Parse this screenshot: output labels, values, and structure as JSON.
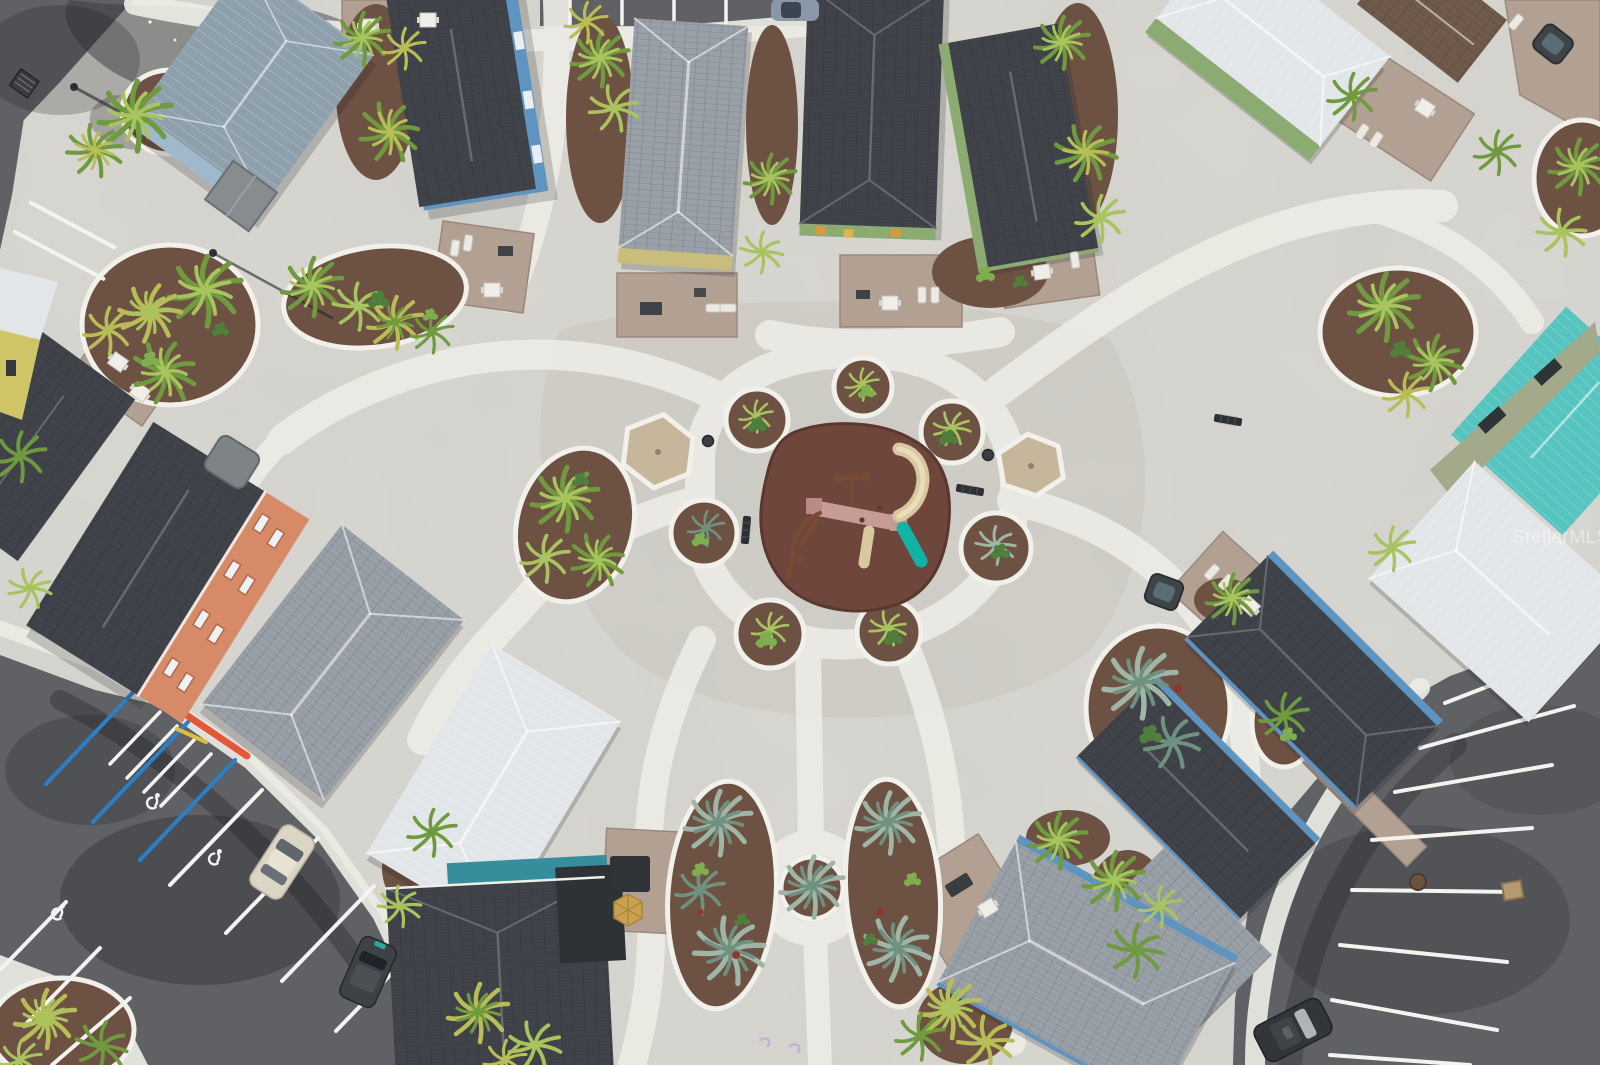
{
  "meta": {
    "type": "aerial-drone-photograph",
    "description": "Overhead drone view of a coastal resort cottage community: rows of small rental cottages with mixed shingle and metal roofs arranged around a central concrete courtyard that has a playground on brown rubber surfacing, sand pads, looping white walkways, mulched palm planting islands, an orange multi-story building at left, and asphalt parking lots with white and blue striping in the lower corners."
  },
  "watermark": {
    "text": "StellarMLS"
  },
  "palette": {
    "concrete": "#d9d7d1",
    "plaza": "#d1cfc8",
    "path": "#ecebe5",
    "curb": "#f2f0ea",
    "asphalt": "#606165",
    "asphalt_dark": "#44454a",
    "mulch": "#6d5244",
    "mulch_dark": "#594336",
    "sand": "#c6b69c",
    "rubber": "#6f463c",
    "rubber_dark": "#5a382e",
    "palm": "#6f9a3e",
    "palm_light": "#a9c45e",
    "palm_yellow": "#b9bd56",
    "palmetto": "#9fb6a6",
    "palmetto_dark": "#70917f",
    "shrub": "#4f7f3a",
    "shrub_light": "#7fae4f",
    "roof_charcoal": "#40444a",
    "roof_ridge": "#646a72",
    "roof_gray": "#9aa0a8",
    "roof_gray_light": "#b0b5bb",
    "roof_metal": "#8fa0ad",
    "roof_white": "#e3e6e9",
    "roof_teal": "#56c4bf",
    "roof_brown": "#705a4b",
    "wall_blue": "#5f93c0",
    "wall_lightblue": "#9fb8cc",
    "wall_green": "#8cab72",
    "wall_orange": "#d78a68",
    "wall_teal": "#368d9c",
    "wall_khaki": "#c9bd7c",
    "wall_sage": "#a3aa8b",
    "paver": "#b2a093",
    "paver_dark": "#9a887c",
    "line_white": "#f4f3f0",
    "line_blue": "#2a7fc6",
    "curb_red": "#e2593a",
    "curb_yellow": "#ddbe3c",
    "slide_teal": "#12b2a4",
    "slide_tan": "#d9c89f",
    "deck_pink": "#c79b96",
    "equip_brown": "#7b4a32",
    "bench": "#2e3134",
    "car_beige": "#dbd5c6",
    "car_dark": "#3e4145",
    "car_suv": "#32363b",
    "car_top": "#8a97a6",
    "shadow": "rgba(30,32,36,0.20)",
    "watermark_color": "rgba(255,255,255,0.45)"
  },
  "scene": {
    "ground": {
      "surfaces": [
        "poured concrete courtyard",
        "white concrete walkways",
        "asphalt parking lots",
        "paver patios",
        "mulch planting beds"
      ]
    },
    "playground": {
      "surface": "brown rubber safety surface",
      "equipment": [
        "climbing structure with pink decks",
        "tan curved tube slide",
        "teal slide",
        "tan straight slide",
        "overhead bar"
      ],
      "nearby": [
        "2 park benches",
        "2 trash cans",
        "2 sand pads"
      ]
    },
    "planting_islands": {
      "edging": "white concrete curb",
      "ground_cover": "brown mulch",
      "plants": [
        "cabbage palms",
        "silver palmettos",
        "yellow-green palms",
        "low shrubs"
      ]
    },
    "buildings": [
      {
        "id": "cottage-nw-metal",
        "type": "cottage",
        "roof": "roof_metal",
        "wall": "wall_lightblue",
        "position": "top-left"
      },
      {
        "id": "cottage-n-blue",
        "type": "cottage",
        "roof": "roof_charcoal",
        "wall": "wall_blue",
        "position": "top, left of center"
      },
      {
        "id": "cottage-n-gray",
        "type": "cottage",
        "roof": "roof_gray",
        "wall": "wall_khaki",
        "position": "top center-left"
      },
      {
        "id": "cottage-n-green",
        "type": "cottage",
        "roof": "roof_charcoal",
        "wall": "wall_green",
        "position": "top center"
      },
      {
        "id": "cottage-n-green2",
        "type": "cottage",
        "roof": "roof_charcoal",
        "wall": "wall_green",
        "position": "top center-right"
      },
      {
        "id": "cottage-ne-white",
        "type": "cottage",
        "roof": "roof_white",
        "wall": "wall_green",
        "position": "top right"
      },
      {
        "id": "cottage-ne-brown",
        "type": "cottage",
        "roof": "roof_brown",
        "wall": "wall_sage",
        "position": "top-right corner"
      },
      {
        "id": "building-e-teal",
        "type": "two-story building",
        "roof": "roof_teal",
        "wall": "wall_sage",
        "position": "right edge"
      },
      {
        "id": "cottage-e-white",
        "type": "cottage",
        "roof": "roof_white",
        "wall": "wall_sage",
        "position": "right"
      },
      {
        "id": "cottage-se-1",
        "type": "cottage",
        "roof": "roof_charcoal",
        "wall": "wall_blue",
        "position": "right of center"
      },
      {
        "id": "cottage-se-2",
        "type": "cottage",
        "roof": "roof_charcoal",
        "wall": "wall_blue",
        "position": "lower right"
      },
      {
        "id": "cottage-se-3",
        "type": "cottage",
        "roof": "roof_gray",
        "wall": "wall_teal",
        "position": "bottom right"
      },
      {
        "id": "building-w-orange",
        "type": "multi-story condo",
        "roof": "roof_charcoal",
        "wall": "wall_orange",
        "position": "left"
      },
      {
        "id": "cottage-w-dark",
        "type": "cottage",
        "roof": "roof_charcoal",
        "wall": "wall_blue",
        "position": "left edge"
      },
      {
        "id": "cottage-w-gray",
        "type": "cottage",
        "roof": "roof_gray",
        "wall": "wall_lightblue",
        "position": "center-left"
      },
      {
        "id": "cottage-w-silver",
        "type": "cottage",
        "roof": "roof_white",
        "wall": "wall_lightblue",
        "position": "center-left lower"
      },
      {
        "id": "cottage-s-teal",
        "type": "cottage",
        "roof": "roof_charcoal",
        "wall": "wall_teal",
        "position": "bottom center-left"
      },
      {
        "id": "cottage-s-blue",
        "type": "cottage",
        "roof": "roof_gray",
        "wall": "wall_blue",
        "position": "bottom center-right"
      }
    ],
    "vehicles": [
      {
        "id": "sedan-beige",
        "type": "sedan",
        "color": "car_beige",
        "position": "southwest parking lot"
      },
      {
        "id": "minivan-dark",
        "type": "minivan",
        "color": "car_dark",
        "position": "southwest parking, lower"
      },
      {
        "id": "suv-dark",
        "type": "suv",
        "color": "car_suv",
        "position": "southeast parking lot"
      },
      {
        "id": "car-top-edge",
        "type": "car",
        "color": "car_top",
        "position": "top edge parking strip"
      }
    ],
    "parking": {
      "striping": [
        "white stall lines",
        "blue accessible stall striping with white hatch"
      ],
      "accessible_symbols": 3,
      "curb_accents": [
        "red curb section",
        "yellow curb tick"
      ],
      "fixtures": [
        "storm drain grate",
        "manhole cover",
        "light poles with shadows"
      ]
    },
    "street_furniture": [
      "picnic tables",
      "sun loungers",
      "grills",
      "hot tubs",
      "park benches",
      "gold patio umbrella",
      "utility enclosures"
    ]
  }
}
